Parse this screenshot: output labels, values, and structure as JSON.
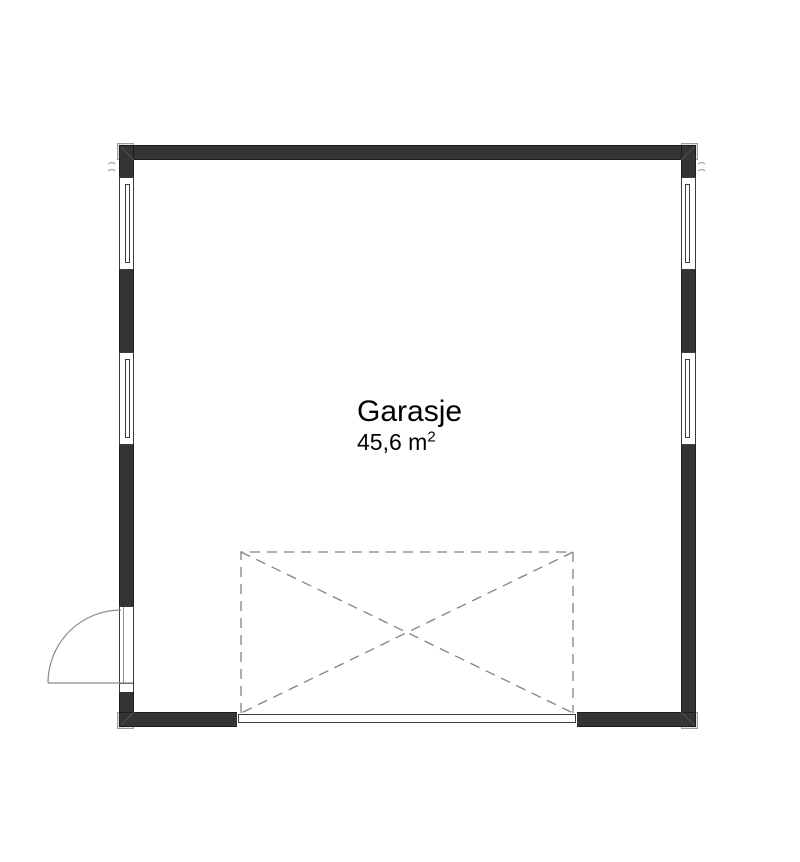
{
  "room": {
    "name": "Garasje",
    "area_text": "45,6 m",
    "area_superscript": "2"
  },
  "plan": {
    "background": "#ffffff",
    "wall_color": "#343434",
    "wall_outline_color": "#1d1d1d",
    "opening_line_color": "#3c3c3c",
    "door_swing_color": "#8a8a8a",
    "dashed_line_color": "#828282",
    "miter_line_color": "#505050",
    "corner_mark_color": "#9a9a9a",
    "corner_post_fill": "#e4e4e4",
    "corner_post_border": "#9e9e9e",
    "text_color": "#000000",
    "windows_count": 4,
    "swing_door_count": 1,
    "garage_door_count": 1
  }
}
